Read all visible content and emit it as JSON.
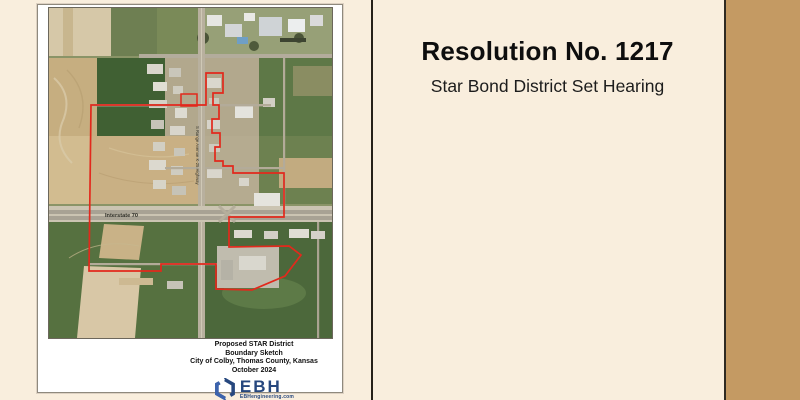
{
  "page": {
    "background_color": "#f9eedd",
    "side_band_color": "#c49a63",
    "divider_color": "#262018"
  },
  "right_panel": {
    "title": "Resolution No. 1217",
    "subtitle": "Star Bond District Set Hearing"
  },
  "map_document": {
    "caption": {
      "line1": "Proposed STAR District",
      "line2": "Boundary Sketch",
      "line3": "City of Colby, Thomas County, Kansas",
      "line4": "October 2024"
    },
    "logo": {
      "company": "EBH",
      "website": "EBHengineering.com",
      "color_dark": "#26477e",
      "color_mid": "#3c63ad"
    },
    "map_labels": {
      "interstate": "Interstate 70",
      "road_vertical": "S Range Avenue K-25 Highway"
    },
    "boundary_color": "#e2291c"
  }
}
